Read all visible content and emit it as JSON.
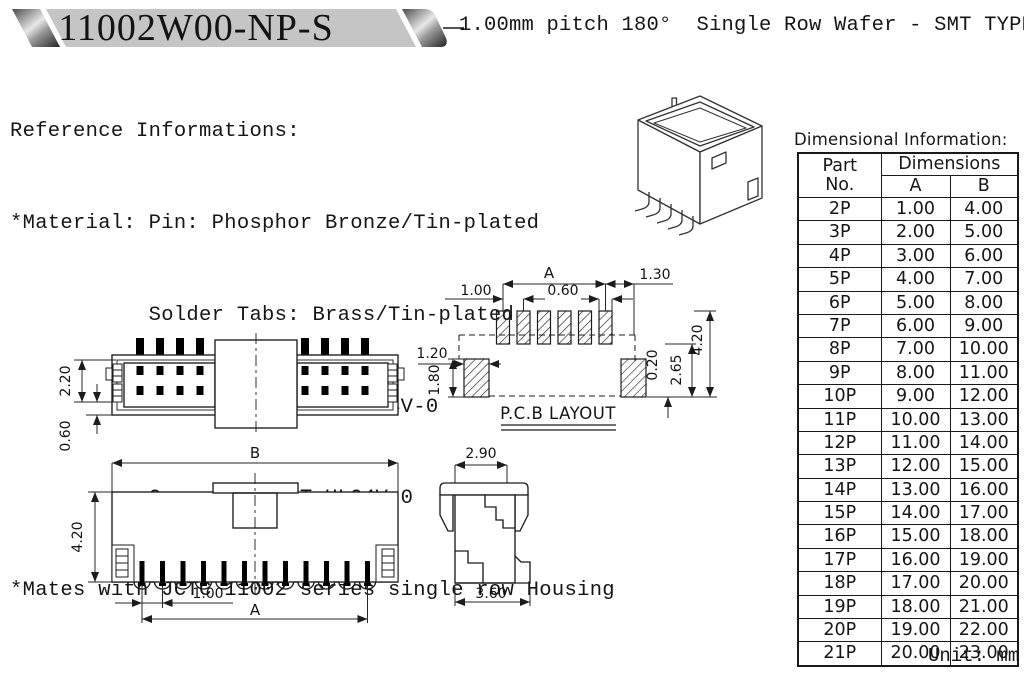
{
  "header": {
    "part_number": "11002W00-NP-S",
    "subtitle": "1.00mm pitch 180°  Single Row Wafer - SMT TYPE"
  },
  "reference": {
    "line1": "Reference Informations:",
    "line2": "*Material: Pin: Phosphor Bronze/Tin-plated",
    "line3": "           Solder Tabs: Brass/Tin-plated",
    "line4": "           Wafer: Nylon 6T,UL94V-0",
    "line5": "           Cap: Nylon 6T,UL94V-0",
    "line6": "*Mates with JCTC 11002 series single row Housing"
  },
  "drawings": {
    "top_view": {
      "dim_height": "2.20",
      "dim_offset": "0.60"
    },
    "pcb_layout": {
      "dim_a": "A",
      "dim_1_30": "1.30",
      "dim_1_00": "1.00",
      "dim_0_60": "0.60",
      "dim_1_20": "1.20",
      "dim_1_80": "1.80",
      "dim_0_20": "0.20",
      "dim_2_65": "2.65",
      "dim_4_20": "4.20",
      "label": "P.C.B LAYOUT"
    },
    "front_view": {
      "dim_b": "B",
      "dim_4_20": "4.20",
      "dim_1_00": "1.00",
      "dim_a": "A"
    },
    "side_view": {
      "dim_2_90": "2.90",
      "dim_3_60": "3.60"
    }
  },
  "table": {
    "title": "Dimensional Information:",
    "col_part": "Part",
    "col_no": "No.",
    "col_dimensions": "Dimensions",
    "col_a": "A",
    "col_b": "B",
    "unit": "Unit: mm",
    "rows": [
      [
        "2P",
        "1.00",
        "4.00"
      ],
      [
        "3P",
        "2.00",
        "5.00"
      ],
      [
        "4P",
        "3.00",
        "6.00"
      ],
      [
        "5P",
        "4.00",
        "7.00"
      ],
      [
        "6P",
        "5.00",
        "8.00"
      ],
      [
        "7P",
        "6.00",
        "9.00"
      ],
      [
        "8P",
        "7.00",
        "10.00"
      ],
      [
        "9P",
        "8.00",
        "11.00"
      ],
      [
        "10P",
        "9.00",
        "12.00"
      ],
      [
        "11P",
        "10.00",
        "13.00"
      ],
      [
        "12P",
        "11.00",
        "14.00"
      ],
      [
        "13P",
        "12.00",
        "15.00"
      ],
      [
        "14P",
        "13.00",
        "16.00"
      ],
      [
        "15P",
        "14.00",
        "17.00"
      ],
      [
        "16P",
        "15.00",
        "18.00"
      ],
      [
        "17P",
        "16.00",
        "19.00"
      ],
      [
        "18P",
        "17.00",
        "20.00"
      ],
      [
        "19P",
        "18.00",
        "21.00"
      ],
      [
        "20P",
        "19.00",
        "22.00"
      ],
      [
        "21P",
        "20.00",
        "23.00"
      ]
    ]
  },
  "colors": {
    "banner_gray": "#c5c5c5",
    "line": "#1c1c1c"
  }
}
